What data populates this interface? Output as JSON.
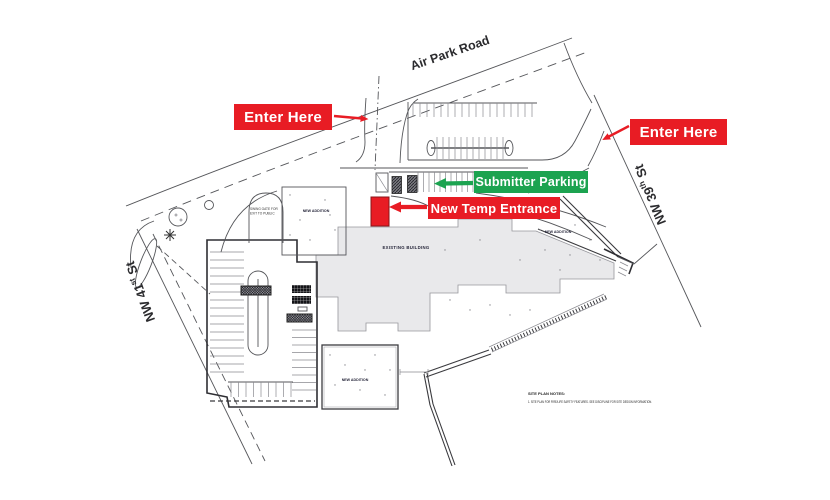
{
  "colors": {
    "annotation_red": "#E81C24",
    "annotation_green": "#1CA350",
    "building_fill": "#E9E9EB",
    "line_color": "#55565A"
  },
  "annotations": {
    "enter_here_left": "Enter Here",
    "enter_here_right": "Enter Here",
    "submitter_parking": "Submitter Parking",
    "new_temp_entrance": "New Temp Entrance"
  },
  "streets": {
    "air_park_road": "Air Park Road",
    "nw_41st": {
      "pre": "NW 41",
      "sup": "st",
      "post": " St"
    },
    "nw_39th": {
      "pre": "NW 39",
      "sup": "th",
      "post": " St"
    }
  },
  "plan_labels": {
    "existing_building": "EXISTING BUILDING",
    "new_addition_west": "NEW ADDITION",
    "new_addition_east": "NEW ADDITION",
    "new_addition_south": "NEW ADDITION",
    "gate_note_line1": "SWING GATE FOR",
    "gate_note_line2": "EXIT TO PUBLIC"
  },
  "notes": {
    "title": "SITE PLAN NOTES:",
    "line1": "1. SITE PLAN FOR FIRE/LIFE SAFETY FEATURES.  SEE DISCIPLINE FOR SITE DESIGN INFORMATION."
  }
}
